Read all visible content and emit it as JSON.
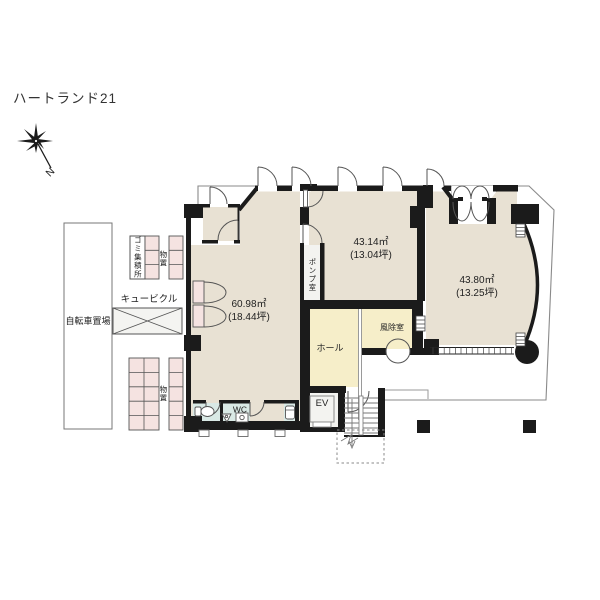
{
  "title": "ハートランド21",
  "compass": {
    "north": "N"
  },
  "site": {
    "bicycle_parking": "自転車置場",
    "garbage_station": "ゴミ集積所",
    "storage_upper": "物置",
    "cubicle": "キュービクル",
    "storage_lower": "物置"
  },
  "rooms": {
    "unit_a": {
      "area_m2": "60.98㎡",
      "area_tsubo": "(18.44坪)"
    },
    "unit_b": {
      "area_m2": "43.14㎡",
      "area_tsubo": "(13.04坪)"
    },
    "unit_c": {
      "area_m2": "43.80㎡",
      "area_tsubo": "(13.25坪)"
    },
    "pump_room": "ポンプ室",
    "hall": "ホール",
    "windbreak_room": "風除室",
    "toilet": "WC",
    "elevator": "EV"
  },
  "colors": {
    "wall": "#1b1b1b",
    "floor-main": "#e8e1d3",
    "floor-warm": "#f6eec9",
    "floor-pink": "#f5e3e1",
    "floor-wc": "#d9e9e5",
    "floor-service": "#f3f3f0",
    "boundary": "#8a8a8a"
  }
}
